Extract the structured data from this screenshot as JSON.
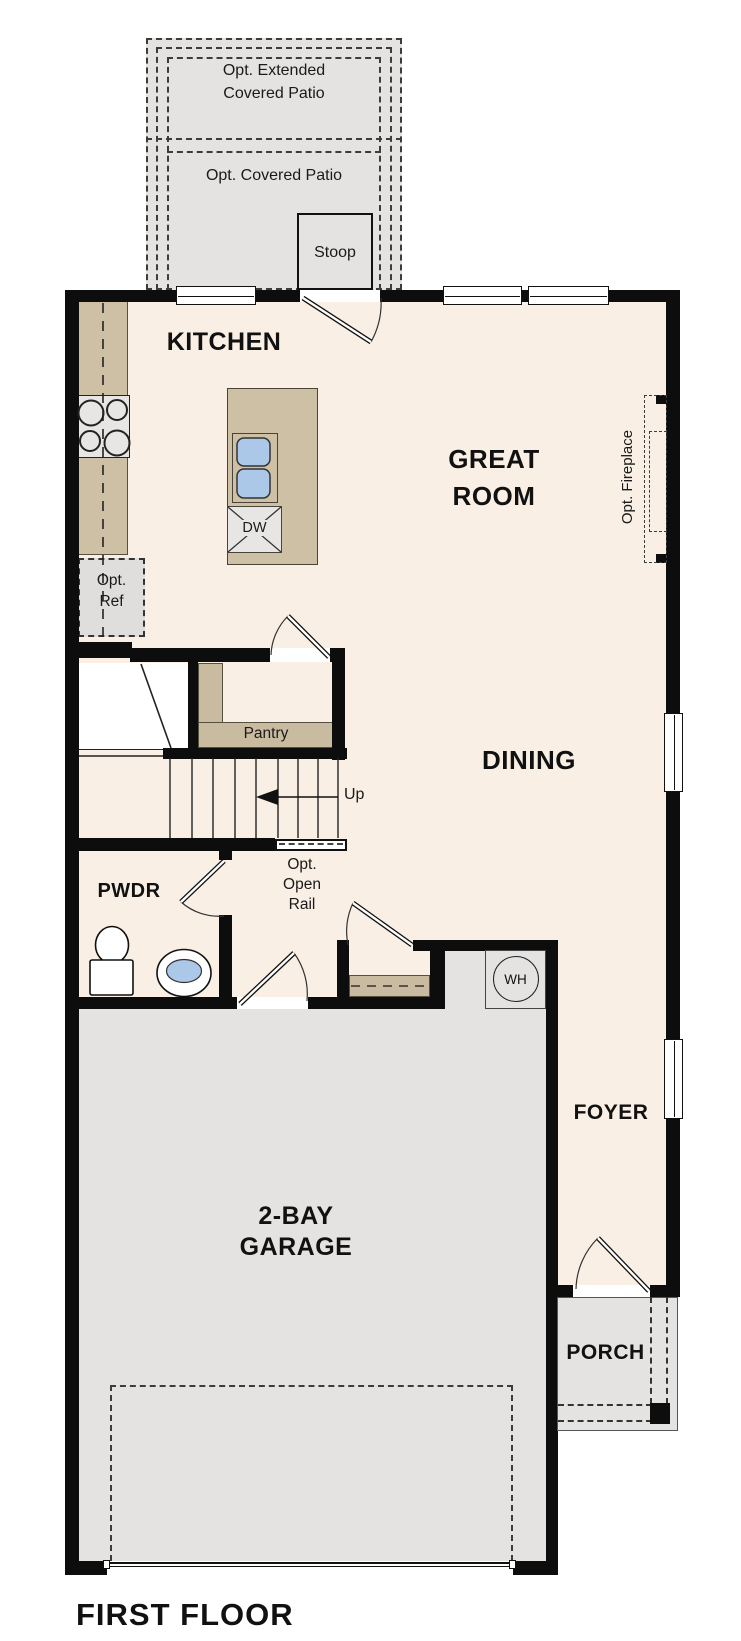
{
  "title": "FIRST FLOOR",
  "rooms": {
    "kitchen": "KITCHEN",
    "great_room": [
      "GREAT",
      "ROOM"
    ],
    "dining": "DINING",
    "pwdr": "PWDR",
    "foyer": "FOYER",
    "garage": [
      "2-BAY",
      "GARAGE"
    ],
    "porch": "PORCH"
  },
  "annotations": {
    "ext_patio": [
      "Opt. Extended",
      "Covered Patio"
    ],
    "cov_patio": "Opt. Covered Patio",
    "stoop": "Stoop",
    "opt_ref": [
      "Opt.",
      "Ref"
    ],
    "pantry": "Pantry",
    "up": "Up",
    "open_rail": [
      "Opt.",
      "Open",
      "Rail"
    ],
    "fireplace": "Opt. Fireplace",
    "dishwasher": "DW",
    "water_heater": "WH"
  },
  "colors": {
    "floor": "#f9efe4",
    "concrete": "#e4e3e1",
    "counter": "#cec0a4",
    "shelf": "#c9bb9f",
    "appliance": "#e7e6e4",
    "sink_blue": "#abc8e8",
    "wall": "#0d0d0d"
  }
}
